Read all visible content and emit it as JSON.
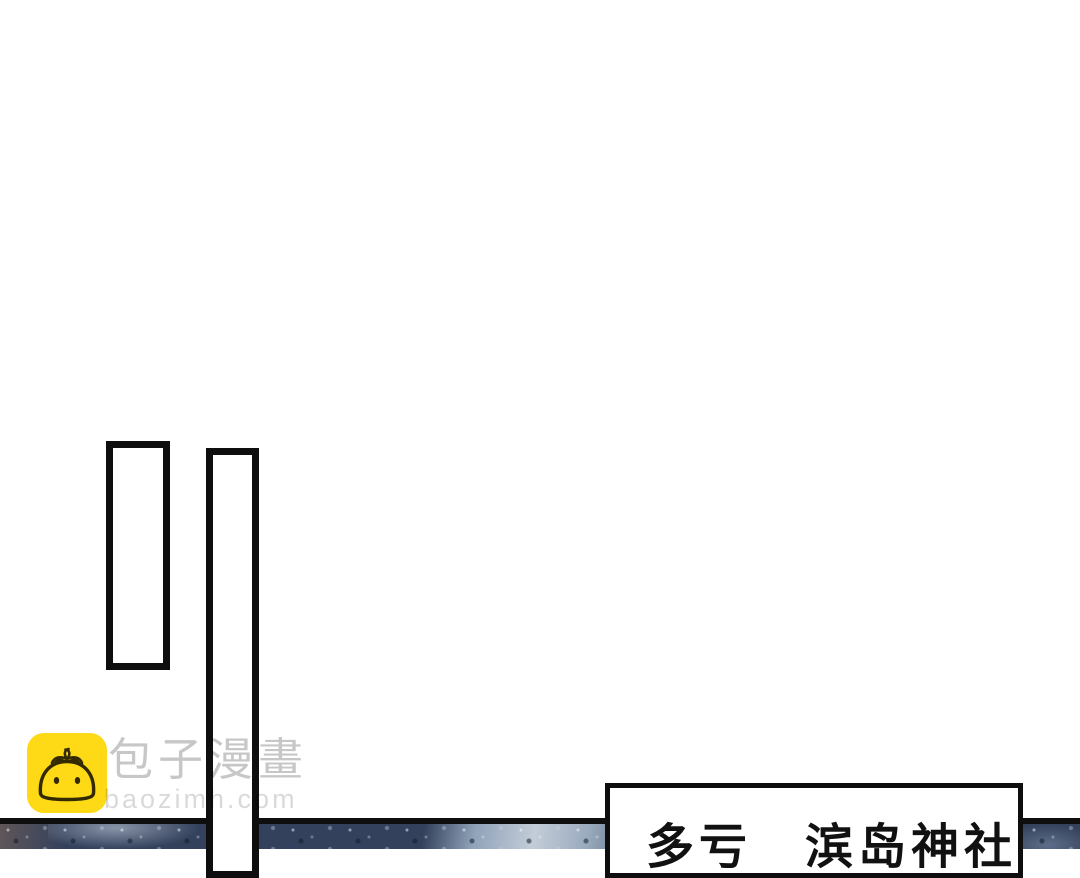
{
  "speech_box": {
    "text": "多亏　滨岛神社"
  },
  "watermark": {
    "brand": "包子漫畫",
    "domain": "baozimh.com",
    "icon": "baozi-bun-icon"
  },
  "colors": {
    "brand_yellow": "#FED916",
    "ink_black": "#0E0E0E",
    "photo_base": "#33415C",
    "photo_light": "#C3CCD8",
    "text_black": "#111111"
  }
}
